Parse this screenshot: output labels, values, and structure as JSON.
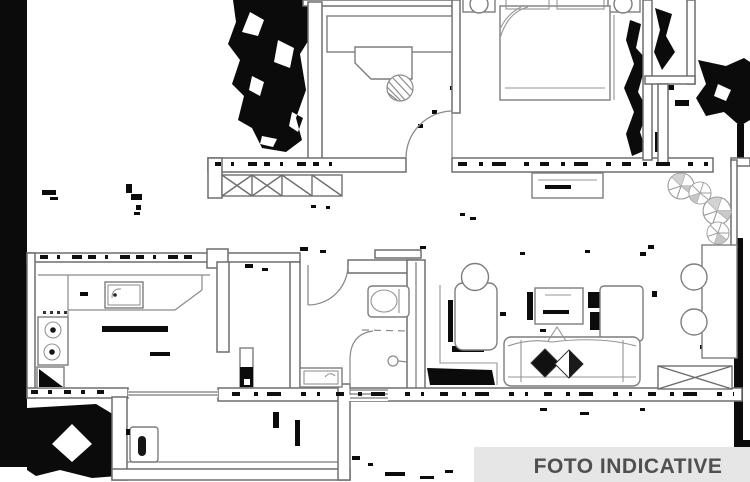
{
  "image_type": "scanned-floor-plan",
  "banner": {
    "text": "FOTO INDICATIVE",
    "background": "#e6e6e6",
    "text_color": "#4f4f4f"
  },
  "plan": {
    "background": "#ffffff",
    "wall_color": "#6e6e6e",
    "furniture_color": "#7d7d7d",
    "artifact_color": "#0b0b0b",
    "upper_zone_elements": [
      "entry-artifact-blob",
      "dressing-room",
      "wardrobe",
      "vanity-desk",
      "wicker-stool",
      "interior-door",
      "bedroom",
      "double-bed",
      "bed-pillows",
      "nightstand-left",
      "nightstand-right",
      "bedside-lamps",
      "radiator-window",
      "window-sill",
      "terrace",
      "terrace-shrubs"
    ],
    "lower_zone_elements": [
      "kitchen",
      "gas-hob",
      "kitchen-sink",
      "corner-unit",
      "worktop",
      "hallway",
      "hall-cabinet",
      "bathroom",
      "bathroom-door",
      "toilet",
      "shower",
      "wash-basin",
      "living-room",
      "armchair",
      "round-side-table",
      "tv-unit",
      "sofa",
      "throw-pillows",
      "bookcase",
      "sideboard",
      "round-stools",
      "radiator-window",
      "utility-room",
      "water-heater"
    ]
  }
}
